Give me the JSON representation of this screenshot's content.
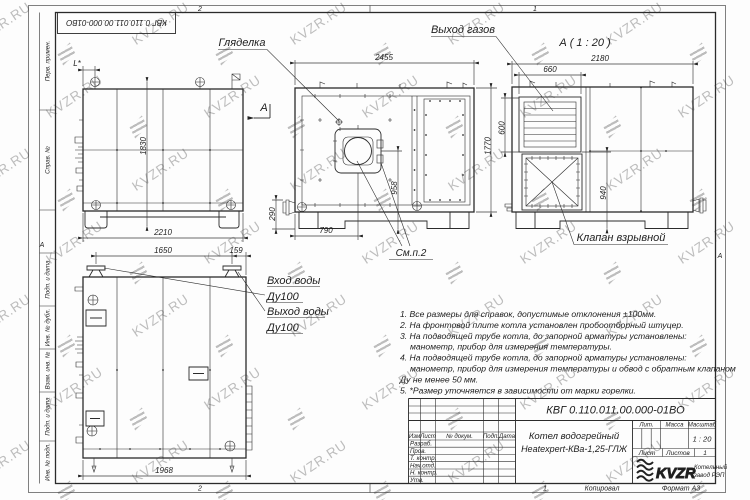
{
  "watermark": {
    "text": "KVZR.RU",
    "color": "#bdbdbd"
  },
  "frame": {
    "zones": {
      "top_left": "2",
      "top_right": "1",
      "bottom_left": "2",
      "left_mid": "А",
      "right_mid": "А"
    },
    "stamps": [
      "Перв. примен.",
      "Справ. №",
      "Подп. и дата",
      "Инв. № дубл.",
      "Взам. инв. №",
      "Подп. и дата",
      "Инв. № подл."
    ],
    "top_designation": "КВГ 0.110.011.00.000-01ВО"
  },
  "callouts": {
    "sight_glass": "Гляделка",
    "gas_outlet": "Выход газов",
    "section_view": "А ( 1 : 20 )",
    "section_arrow": "А",
    "explosion_valve": "Клапан взрывной",
    "see_item": "См.п.2",
    "water_in_1": "Вход воды",
    "water_in_2": "Ду100",
    "water_out_1": "Выход воды",
    "water_out_2": "Ду100"
  },
  "dimensions": {
    "view1": {
      "l_star": "L*",
      "height": "1830",
      "width": "2210",
      "nozzle": "290"
    },
    "view2": {
      "width": "2455",
      "height": "1770",
      "burner_h": "958",
      "burner_x": "790"
    },
    "view3": {
      "width": "2180",
      "louver_w": "660",
      "louver_h": "600",
      "valve_h": "940"
    },
    "view4": {
      "span1": "1650",
      "span2": "159",
      "width": "1968"
    }
  },
  "notes": {
    "lines": [
      "1. Все размеры для справок, допустимые отклонения ±100мм.",
      "2. На фронтовой плите котла установлен пробоотборный штуцер.",
      "3. На подводящей трубе котла, до запорной арматуры установлены:",
      "манометр, прибор для измерения температуры.",
      "4. На подводящей трубе котла, до запорной арматуры установлены:",
      "манометр, прибор для измерения температуры и обвод с обратным клапаном",
      "Ду не менее 50 мм.",
      "5. *Размер уточняется в зависимости от марки горелки."
    ]
  },
  "title_block": {
    "designation": "КВГ 0.110.011.00.000-01ВО",
    "product_line1": "Котел водогрейный",
    "product_line2": "Heatexpert-КВа-1,25-ГЛЖ",
    "cols": {
      "izm": "Изм",
      "list": "Лист",
      "doc": "№ докум.",
      "sign": "Подп.",
      "date": "Дата"
    },
    "rows": [
      "Разраб.",
      "Пров.",
      "Т. контр.",
      "Нач.отд.",
      "Н. контр.",
      "Утв."
    ],
    "lit_label": "Лит.",
    "mass_label": "Масса",
    "scale_label": "Масштаб",
    "scale_value": "1 : 20",
    "sheet_label": "Лист",
    "sheets_label": "Листов",
    "sheets_value": "1",
    "company_logo": "KVZR",
    "company_line1": "Котельный",
    "company_line2": "завод РЭП",
    "footer": {
      "zone": "1",
      "copied": "Копировал",
      "format": "Формат А3"
    }
  }
}
